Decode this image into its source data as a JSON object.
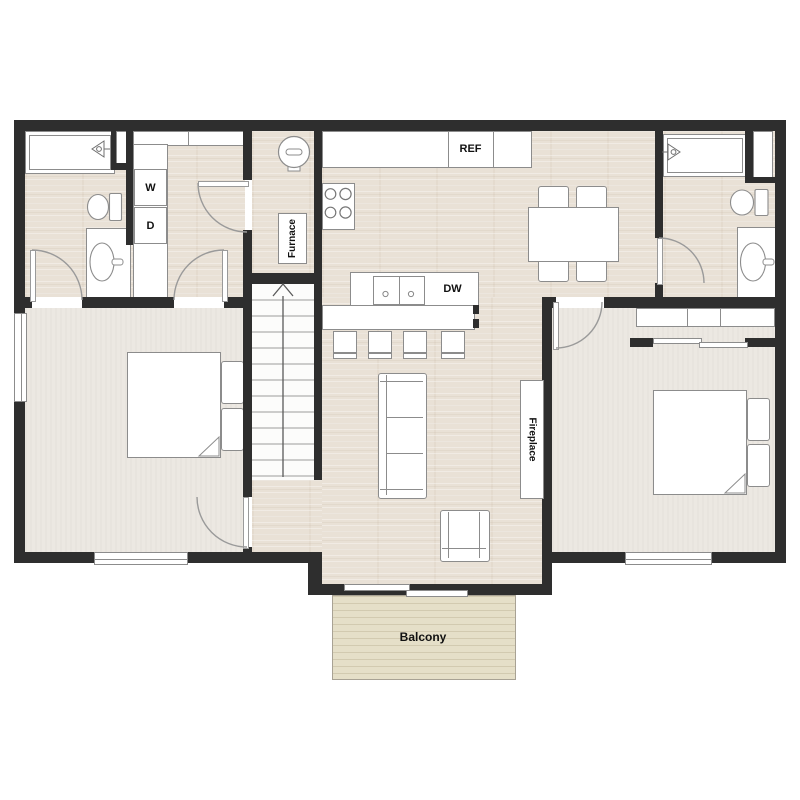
{
  "floorplan": {
    "labels": {
      "refrigerator": "REF",
      "washer": "W",
      "dryer": "D",
      "furnace": "Furnace",
      "dishwasher": "DW",
      "fireplace": "Fireplace",
      "balcony": "Balcony"
    },
    "colors": {
      "wall": "#2e2e2e",
      "wood_floor": "#e9e1d6",
      "carpet": "#ece8e2",
      "balcony_deck": "#e5dfc8",
      "fixture_outline": "#8c8c8c",
      "fixture_fill": "#ffffff",
      "label_text": "#111111",
      "background": "#ffffff"
    }
  }
}
